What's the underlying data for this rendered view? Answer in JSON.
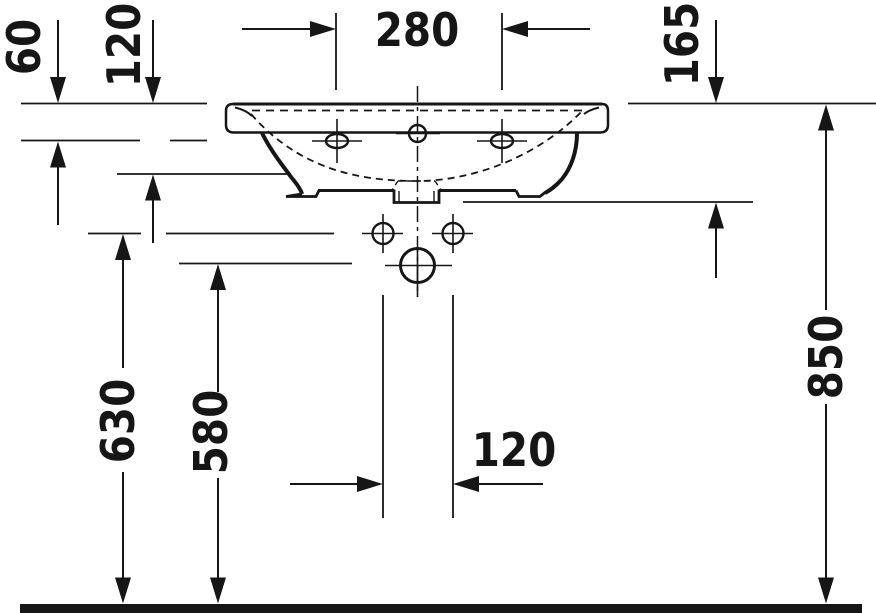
{
  "diagram": {
    "type": "technical-dimension-drawing",
    "subject": "wall-mounted washbasin, front elevation",
    "units": "mm",
    "colors": {
      "line": "#161616",
      "background": "#ffffff",
      "floor": "#161616"
    },
    "dimensions": [
      {
        "id": "dim-60",
        "label": "60",
        "orientation": "vertical"
      },
      {
        "id": "dim-120-top",
        "label": "120",
        "orientation": "vertical"
      },
      {
        "id": "dim-280",
        "label": "280",
        "orientation": "horizontal"
      },
      {
        "id": "dim-165",
        "label": "165",
        "orientation": "vertical"
      },
      {
        "id": "dim-850",
        "label": "850",
        "orientation": "vertical"
      },
      {
        "id": "dim-630",
        "label": "630",
        "orientation": "vertical"
      },
      {
        "id": "dim-580",
        "label": "580",
        "orientation": "vertical"
      },
      {
        "id": "dim-120-bottom",
        "label": "120",
        "orientation": "horizontal"
      }
    ]
  }
}
